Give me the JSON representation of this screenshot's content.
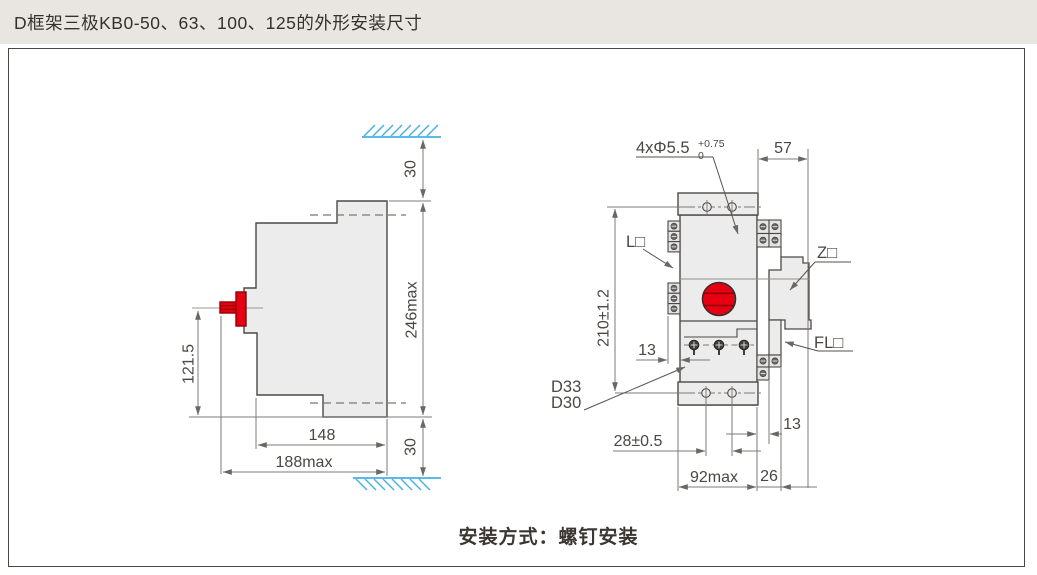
{
  "title": "D框架三极KB0-50、63、100、125的外形安装尺寸",
  "footer": "安装方式：螺钉安装",
  "colors": {
    "titlebar_bg": "#e9e6e1",
    "panel_border": "#4b4641",
    "outline": "#4d4945",
    "body_fill": "#ececec",
    "dim_lines": "#7d7a78",
    "accent_red": "#e60012",
    "hatch_blue": "#45b0e5"
  },
  "side_view": {
    "dim_top_clearance": "30",
    "dim_height_max": "246max",
    "dim_bottom_clearance": "30",
    "dim_handle_center_height": "121.5",
    "dim_depth_body": "148",
    "dim_depth_max": "188max"
  },
  "front_view": {
    "hole_callout_base": "4xΦ5.5",
    "hole_callout_tol_upper": "+0.75",
    "hole_callout_tol_lower": "0",
    "dim_side_width": "57",
    "dim_mount_hole_vspacing": "210±1.2",
    "dim_terminal_depth": "13",
    "dim_mount_hole_hspacing": "28±0.5",
    "dim_width_max": "92max",
    "dim_right_attachment_width": "26",
    "dim_right_strip_width": "13",
    "label_left_accessory": "L□",
    "label_right_accessory": "Z□",
    "label_flange_accessory": "FL□",
    "label_model_a": "D33",
    "label_model_b": "D30"
  }
}
